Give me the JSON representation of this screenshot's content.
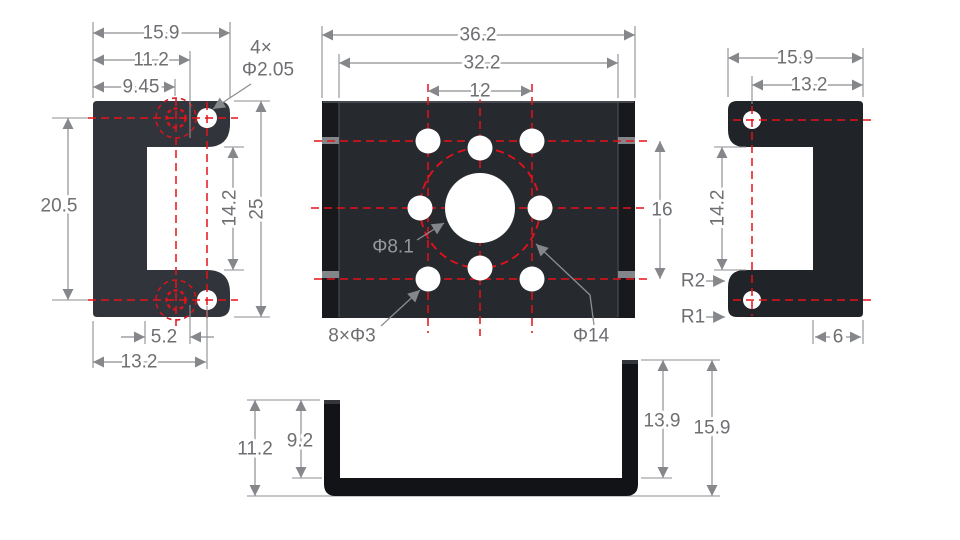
{
  "drawing": {
    "left_view": {
      "w_total": "15.9",
      "w_hole_inner": "11.2",
      "w_hidden": "9.45",
      "callout_count": "4×",
      "callout_dia": "Φ2.05",
      "h_hole_span": "20.5",
      "h_notch": "14.2",
      "h_total": "25",
      "w_offset": "5.2",
      "w_hole_outer": "13.2"
    },
    "front_view": {
      "w_total": "36.2",
      "w_inner": "32.2",
      "hole_span_x": "12",
      "hole_span_y": "16",
      "center_hole": "Φ8.1",
      "pattern_holes": "8×Φ3",
      "bolt_circle": "Φ14"
    },
    "right_view": {
      "w_total": "15.9",
      "w_hole": "13.2",
      "h_notch": "14.2",
      "radius_inner": "R2",
      "radius_outer": "R1",
      "wall_thickness": "6"
    },
    "bottom_view": {
      "h_outer_left": "11.2",
      "h_inner_left": "9.2",
      "h_inner_right": "13.9",
      "h_outer_right": "15.9"
    },
    "colors": {
      "part_dark": "#26292e",
      "part_black": "#121316",
      "centerline_red": "#e8111a",
      "dimension_gray": "#8d8e91",
      "text_gray": "#6e6f72",
      "background": "#ffffff"
    }
  }
}
